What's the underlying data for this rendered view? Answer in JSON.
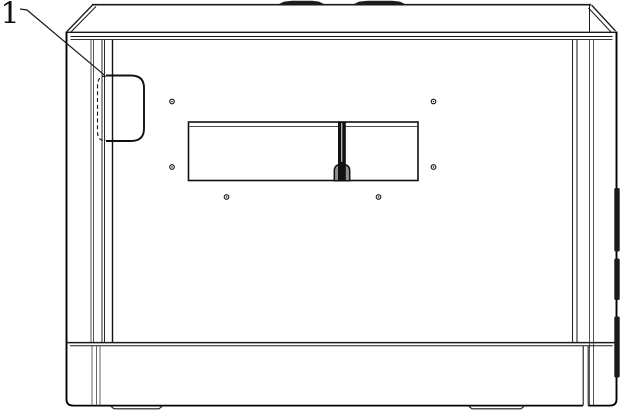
{
  "figure": {
    "kind": "technical-line-drawing",
    "view": "machine rear elevation",
    "reference_numerals": [
      {
        "label": "1",
        "points_to": "side-handle-cutout"
      }
    ],
    "colors": {
      "line": "#1a1a1a",
      "line_heavy": "#000000",
      "background": "#ffffff",
      "pad_fill": "#1c1c1c",
      "slot_fill": "#111111",
      "slot_cap_fill": "#8f8f8f",
      "hinge_fill": "#1b1b1b"
    }
  }
}
